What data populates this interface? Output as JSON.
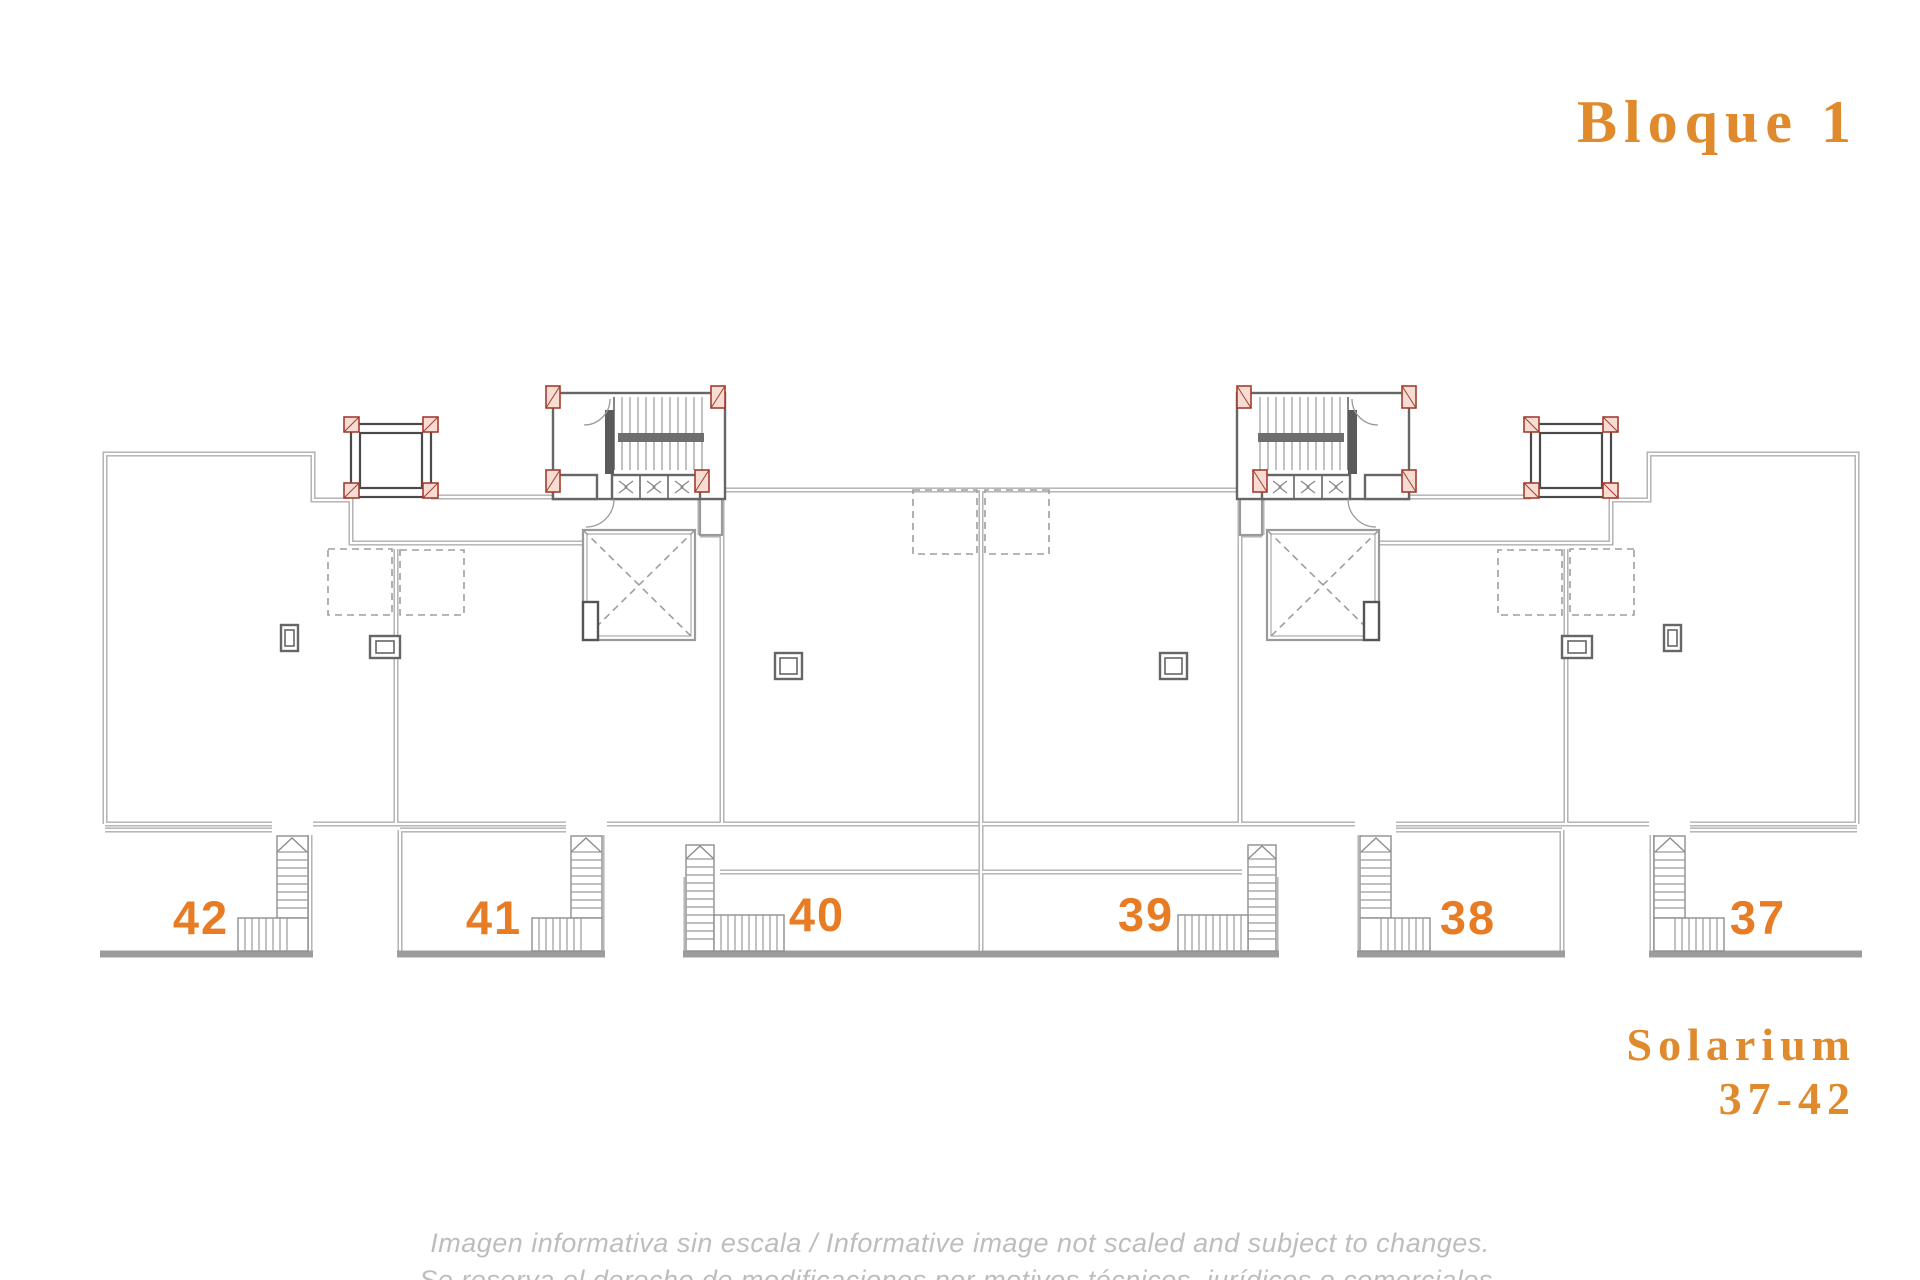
{
  "header": {
    "title": "Bloque 1"
  },
  "plan": {
    "units": [
      {
        "id": "42",
        "label": "42"
      },
      {
        "id": "41",
        "label": "41"
      },
      {
        "id": "40",
        "label": "40"
      },
      {
        "id": "39",
        "label": "39"
      },
      {
        "id": "38",
        "label": "38"
      },
      {
        "id": "37",
        "label": "37"
      }
    ]
  },
  "legend": {
    "name_line": "Solarium",
    "range_line": "37-42"
  },
  "footer": {
    "disclaimer_line1": "Imagen informativa sin escala /  Informative image not scaled and subject to changes.",
    "disclaimer_line2": "Se reserva el derecho de modificaciones por motivos técnicos, jurídicos o comerciales."
  },
  "colors": {
    "accent_orange": "#e08a2e",
    "unit_number_orange": "#e87c24",
    "wall_gray": "#aeaeae",
    "detail_dark_gray": "#666666",
    "column_red": "#a43c2f",
    "disclaimer_gray": "#bdbdbd",
    "background": "#ffffff"
  },
  "icons": {
    "stair_direction_arrow": "chevron-up",
    "vent_marker": "><"
  }
}
